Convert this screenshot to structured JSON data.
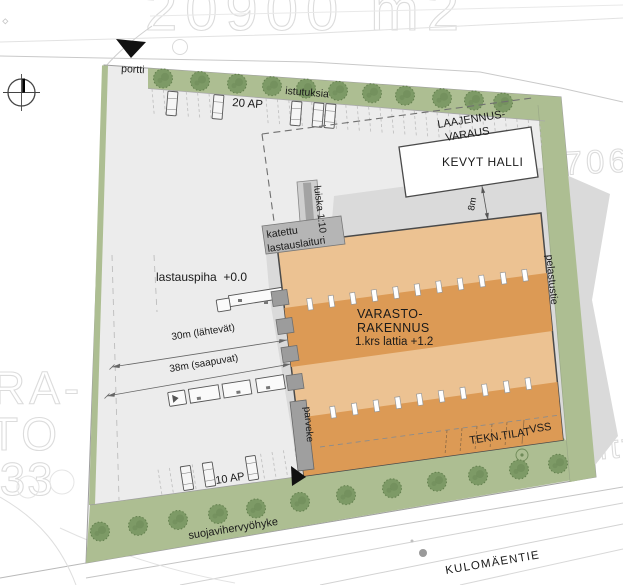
{
  "colors": {
    "site": "#ececec",
    "green": "#adbe92",
    "tree": "#7d9a66",
    "tree_edge": "#64804f",
    "orange_light": "#ecc292",
    "orange_dark": "#dc9a55",
    "building_border": "#4a4a4a",
    "shadow": "#dadada",
    "hall_fill": "#ffffff",
    "canopy": "#b5b5b5",
    "ramp": "#cfcfcf",
    "ramp_dark": "#a3a3a3",
    "dock": "#9c9c9c",
    "balcony": "#9f9f9f",
    "road_line": "#c9c9c9",
    "marker_black": "#111111"
  },
  "ghost": {
    "top_area": "20900 m2",
    "right_parcel": "5706",
    "right_lot": "tontti",
    "left_1": "RA-",
    "left_2": "TO",
    "left_3": "733"
  },
  "site": {
    "gate_label": "portti",
    "plantings_label": "istutuksia",
    "parking_top_label": "20 AP",
    "parking_bottom_label": "10 AP",
    "loading_yard_label": "lastauspiha  +0.0",
    "dim_30m_label": "30m (lähtevät)",
    "dim_38m_label": "38m (saapuvat)",
    "dim_8m_label": "8m",
    "expansion_line1": "LAAJENNUS-",
    "expansion_line2": "VARAUS",
    "light_hall_label": "KEVYT HALLI",
    "ramp_label": "luiska 1:10",
    "dock_line1": "katettu",
    "dock_line2": "lastauslaituri",
    "warehouse_line1": "VARASTO-",
    "warehouse_line2": "RAKENNUS",
    "warehouse_line3": "1.krs lattia +1.2",
    "balcony_label": "parveke",
    "rescue_road_label": "pelastustie",
    "tech_room_label": "TEKN.TILAT",
    "shelter_label": "VSS",
    "buffer_zone_label": "suojavihervyöhyke",
    "street_label": "KULOMÄENTIE"
  }
}
